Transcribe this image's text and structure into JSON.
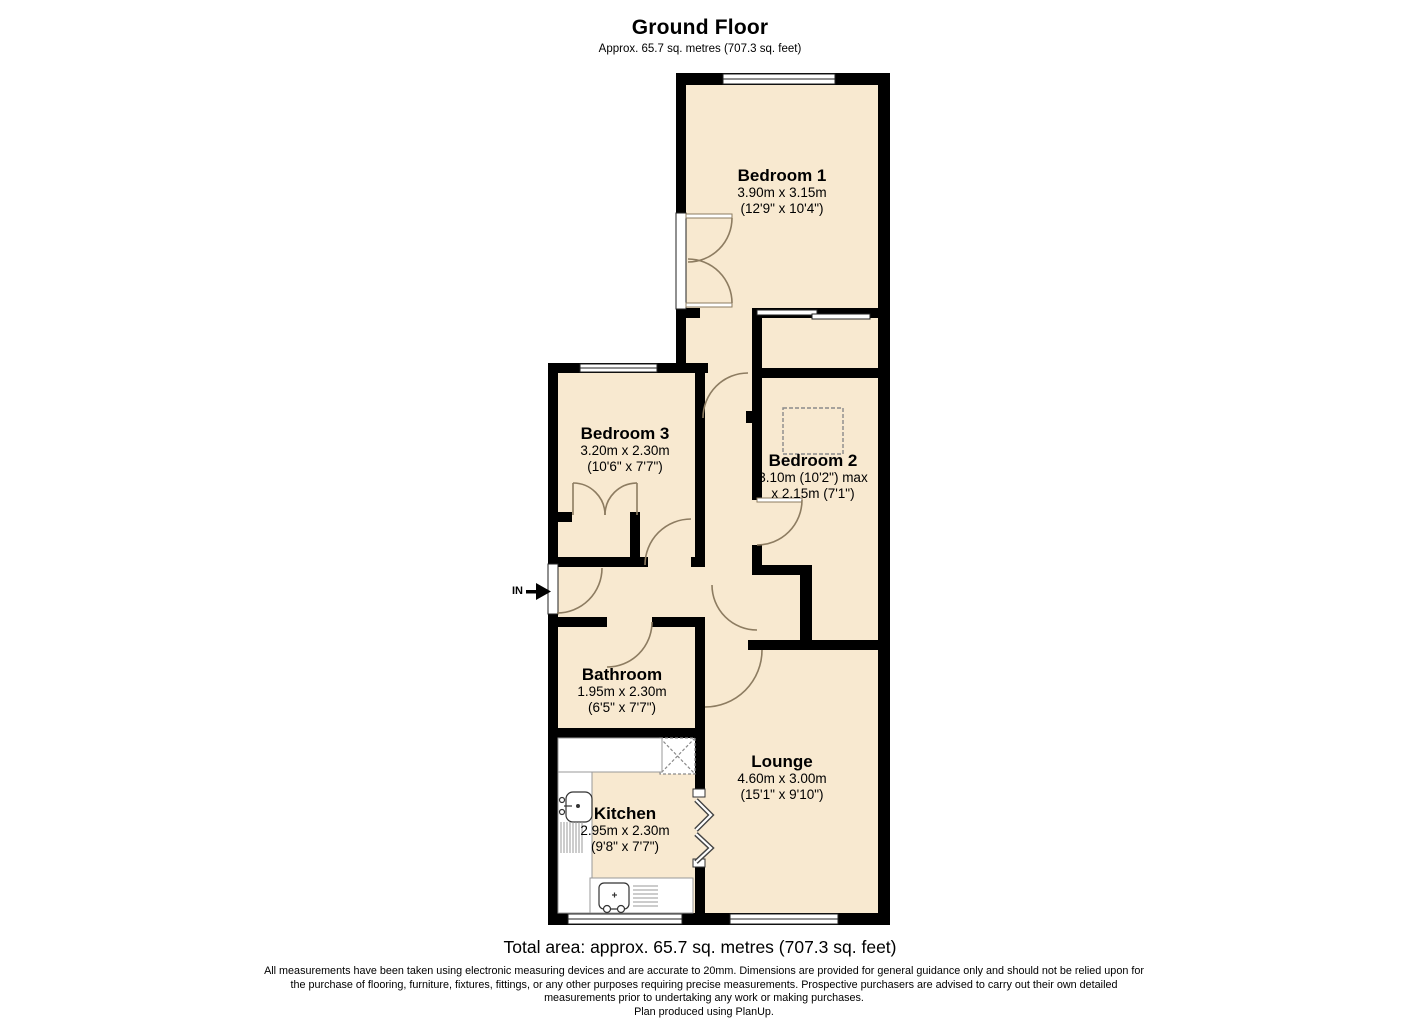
{
  "title": {
    "heading": "Ground Floor",
    "subheading": "Approx. 65.7 sq. metres (707.3 sq. feet)"
  },
  "rooms": [
    {
      "id": "bedroom1",
      "name": "Bedroom 1",
      "dim_metric": "3.90m x 3.15m",
      "dim_imperial": "(12'9\" x 10'4\")"
    },
    {
      "id": "bedroom3",
      "name": "Bedroom 3",
      "dim_metric": "3.20m x 2.30m",
      "dim_imperial": "(10'6\" x 7'7\")"
    },
    {
      "id": "bedroom2",
      "name": "Bedroom 2",
      "dim_metric": "3.10m (10'2\") max",
      "dim_imperial": "x 2.15m (7'1\")"
    },
    {
      "id": "bathroom",
      "name": "Bathroom",
      "dim_metric": "1.95m x 2.30m",
      "dim_imperial": "(6'5\" x 7'7\")"
    },
    {
      "id": "kitchen",
      "name": "Kitchen",
      "dim_metric": "2.95m x 2.30m",
      "dim_imperial": "(9'8\" x 7'7\")"
    },
    {
      "id": "lounge",
      "name": "Lounge",
      "dim_metric": "4.60m x 3.00m",
      "dim_imperial": "(15'1\" x 9'10\")"
    }
  ],
  "entrance_label": "IN",
  "footer": {
    "total_area": "Total area: approx. 65.7 sq. metres (707.3 sq. feet)",
    "disclaimer_lines": [
      "All measurements have been taken using electronic measuring devices and are accurate to 20mm. Dimensions are provided for general guidance only and should not be relied upon for",
      "the purchase of flooring, furniture, fixtures, fittings, or any other purposes requiring precise measurements. Prospective purchasers are advised to carry out their own detailed",
      "measurements prior to undertaking any work or making purchases."
    ],
    "credit": "Plan produced using PlanUp."
  },
  "colors": {
    "room_fill": "#f8e9d0",
    "wall": "#000000",
    "door_arc": "#8d7c61"
  }
}
